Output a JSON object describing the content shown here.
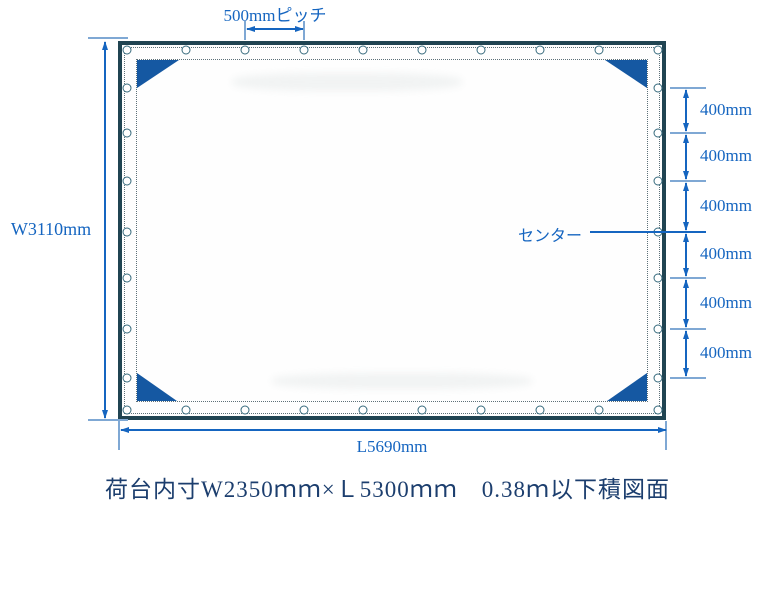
{
  "caption": "荷台内寸W2350ｍｍ×Ｌ5300ｍｍ　0.38ｍ以下積図面",
  "dimensions": {
    "pitch_label": "500mmピッチ",
    "width_label": "W3110mm",
    "length_label": "L5690mm",
    "center_label": "センター",
    "segment_labels": [
      "400mm",
      "400mm",
      "400mm",
      "400mm",
      "400mm",
      "400mm"
    ]
  },
  "colors": {
    "accent_blue": "#1565c0",
    "light_blue": "#7fa8d4",
    "tarp_border": "#204452",
    "corner_patch": "#1558a2",
    "caption_text": "#1c3e6e"
  },
  "geometry": {
    "right_tick_y": [
      88,
      133,
      181,
      232,
      278,
      329,
      378
    ],
    "center_tick_index": 3,
    "grommet_top_x": [
      5,
      64,
      123,
      182,
      241,
      300,
      359,
      418,
      477,
      536
    ],
    "grommet_side_y": [
      43,
      88,
      136,
      187,
      233,
      284,
      333
    ],
    "grommet_row_top_y": 5,
    "grommet_row_bottom_y": 365,
    "grommet_col_left_x": 5,
    "grommet_col_right_x": 536
  }
}
